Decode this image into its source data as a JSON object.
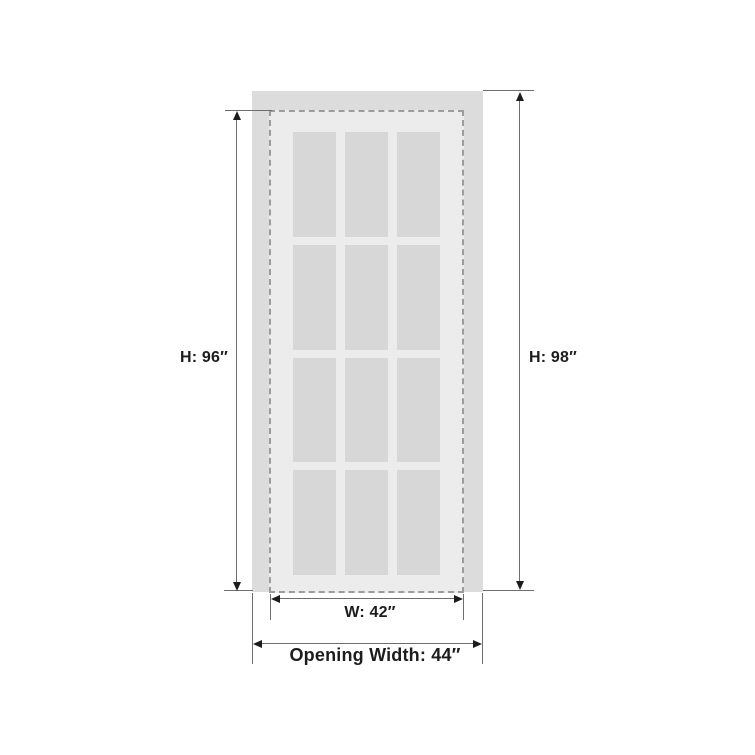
{
  "diagram": {
    "type": "door-dimension-diagram",
    "labels": {
      "door_height": "H: 96″",
      "opening_height": "H: 98″",
      "door_width": "W: 42″",
      "opening_width": "Opening Width: 44″"
    },
    "panes": {
      "rows": 4,
      "cols": 3
    },
    "colors": {
      "bg": "#ffffff",
      "opening": "#dcdcdc",
      "door": "#ececec",
      "pane": "#d7d7d7",
      "dash": "#9c9c9c",
      "line": "#6e6e6e",
      "arrow": "#1c1c1c",
      "text": "#1d1d1d"
    }
  }
}
